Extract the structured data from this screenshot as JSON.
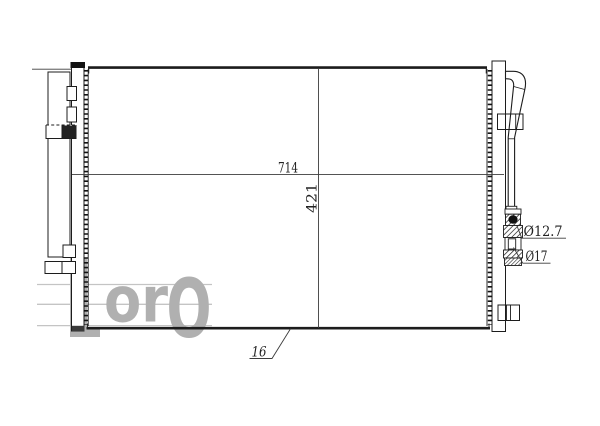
{
  "page": {
    "background": "#ffffff",
    "kind": "technical-drawing-screenshot"
  },
  "drawing": {
    "subject": "automotive-condenser-front-view",
    "colors": {
      "line": "#1c1c1c",
      "dimension_line": "#3c3c3c",
      "watermark": "#b0b0b0",
      "watermark_line": "#c4c4c4"
    },
    "dimensions": {
      "width": "714",
      "height": "421",
      "depth": "16",
      "fitting_small": "Ø12.7",
      "fitting_large": "Ø17"
    },
    "watermark": {
      "letter_l": "L",
      "letters_or": "or",
      "letter_o_cap": "O"
    }
  }
}
